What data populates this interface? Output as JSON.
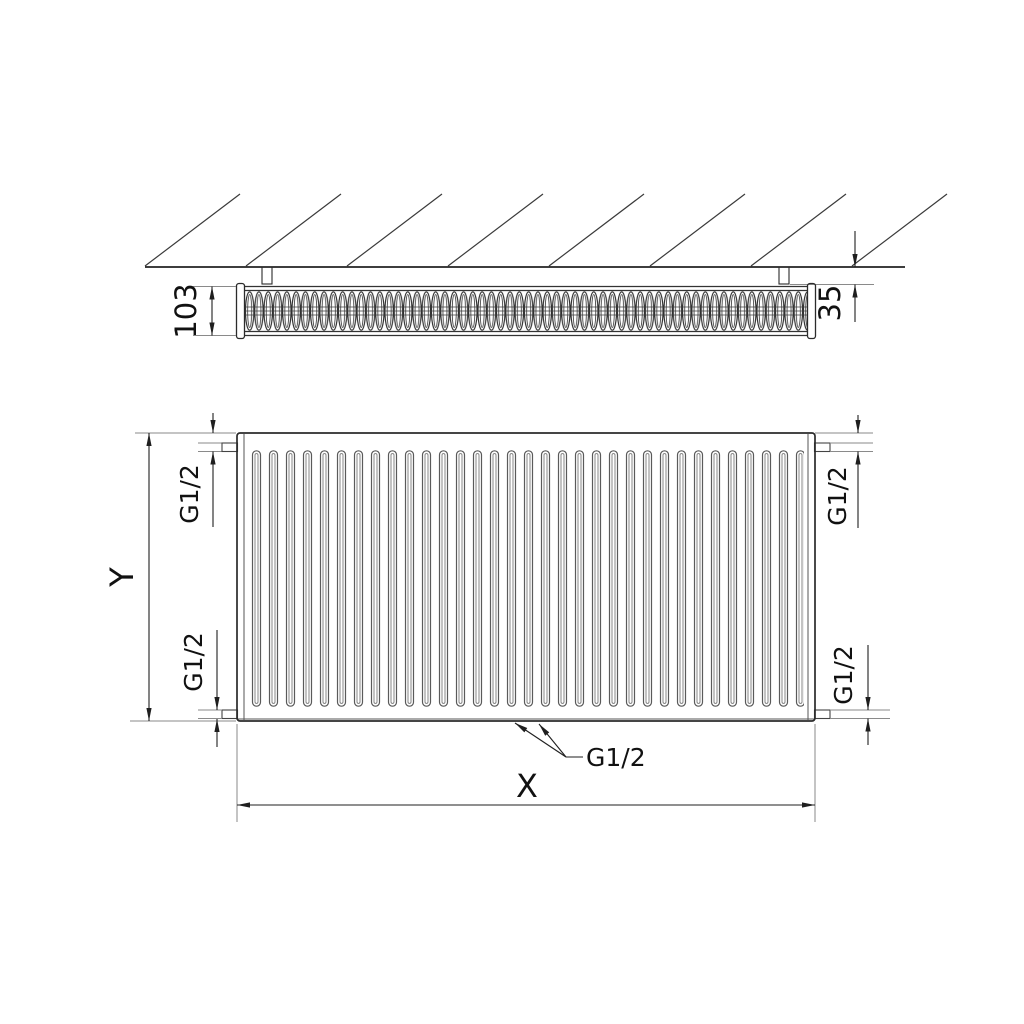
{
  "labels": {
    "depth": "103",
    "wall_distance": "35",
    "height": "Y",
    "width": "X",
    "thread_top_left": "G1/2",
    "thread_top_right": "G1/2",
    "thread_bottom_left": "G1/2",
    "thread_bottom_right": "G1/2",
    "thread_bottom_center": "G1/2"
  },
  "colors": {
    "object_line": "#2b2b2b",
    "extension_line": "#8a8a8a",
    "dimension_line": "#1f1f1f",
    "text": "#111111",
    "background": "#ffffff"
  },
  "views": {
    "top": "radiator-top-cross-section-at-wall",
    "front": "radiator-front-elevation"
  }
}
